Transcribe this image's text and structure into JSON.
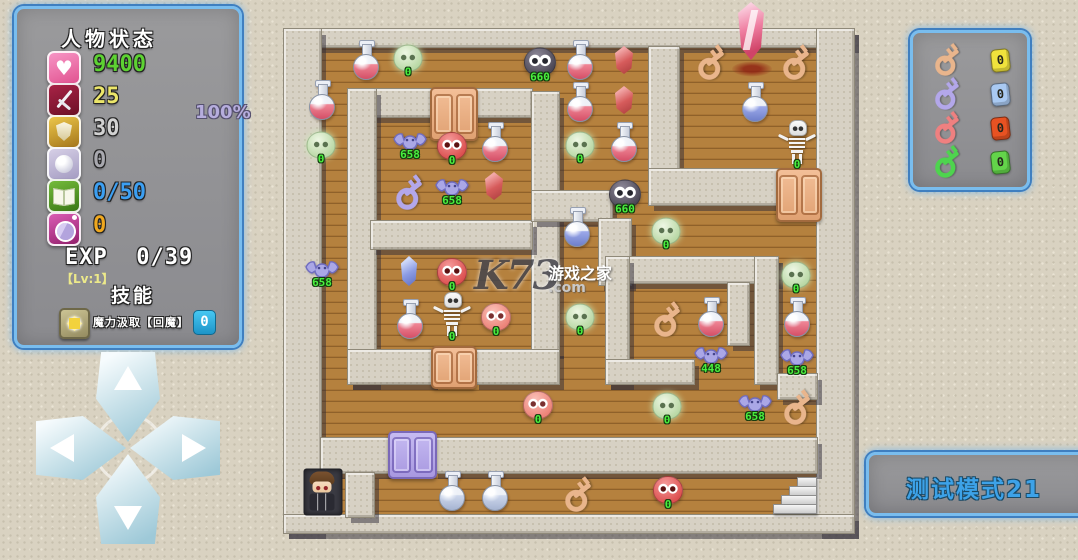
{
  "status_panel": {
    "title": "人物状态",
    "hit_rate": "100%",
    "stats": [
      {
        "icon": "heart",
        "value": "9400",
        "color": "#5dd232"
      },
      {
        "icon": "attack",
        "value": "25",
        "color": "#ece66a"
      },
      {
        "icon": "shield",
        "value": "30",
        "color": "#d2d2d2"
      },
      {
        "icon": "orb",
        "value": "0",
        "color": "#a9a9af"
      },
      {
        "icon": "book",
        "value": "0/50",
        "color": "#3c9ff2"
      },
      {
        "icon": "coin",
        "value": "0",
        "color": "#f0a81e"
      }
    ],
    "exp_label": "EXP",
    "exp_value": "0/39",
    "level": "【Lv:1】",
    "skills_title": "技能",
    "skill": {
      "name": "魔力汲取【回魔】",
      "value": "0"
    }
  },
  "key_panel": {
    "keys": [
      {
        "name": "orange-key",
        "count": "0",
        "key_class": "orange",
        "badge_color": "#f0e23c"
      },
      {
        "name": "blue-key",
        "count": "0",
        "key_class": "purple",
        "badge_color": "#a9c9f2"
      },
      {
        "name": "red-key",
        "count": "0",
        "key_class": "redk",
        "badge_color": "#e85222"
      },
      {
        "name": "green-key",
        "count": "0",
        "key_class": "greenk",
        "badge_color": "#63d44a"
      }
    ]
  },
  "mode_label": "测试模式21",
  "watermark": {
    "logo": "K73",
    "site_name": "游戏之家",
    "domain": ".com"
  },
  "dpad": {
    "directions": [
      "up",
      "left",
      "right",
      "down"
    ]
  },
  "maze": {
    "origin": {
      "x": 283,
      "y": 28
    },
    "walls": [
      [
        283,
        28,
        570,
        18
      ],
      [
        283,
        28,
        37,
        504
      ],
      [
        816,
        28,
        37,
        504
      ],
      [
        283,
        514,
        570,
        18
      ],
      [
        648,
        46,
        30,
        152
      ],
      [
        648,
        168,
        132,
        36
      ],
      [
        347,
        88,
        184,
        28
      ],
      [
        347,
        88,
        28,
        295
      ],
      [
        531,
        91,
        27,
        261
      ],
      [
        370,
        220,
        161,
        28
      ],
      [
        347,
        349,
        85,
        34
      ],
      [
        473,
        349,
        85,
        34
      ],
      [
        531,
        190,
        80,
        30
      ],
      [
        598,
        218,
        32,
        66
      ],
      [
        605,
        256,
        172,
        26
      ],
      [
        605,
        256,
        23,
        127
      ],
      [
        605,
        359,
        88,
        24
      ],
      [
        754,
        256,
        23,
        127
      ],
      [
        727,
        282,
        21,
        62
      ],
      [
        777,
        373,
        39,
        25
      ],
      [
        320,
        437,
        69,
        35
      ],
      [
        432,
        437,
        384,
        35
      ],
      [
        345,
        472,
        28,
        44
      ]
    ],
    "doors": [
      {
        "x": 430,
        "y": 87,
        "w": 44,
        "h": 50,
        "color": "orange"
      },
      {
        "x": 776,
        "y": 168,
        "w": 42,
        "h": 50,
        "color": "orange"
      },
      {
        "x": 431,
        "y": 346,
        "w": 42,
        "h": 39,
        "color": "orange"
      },
      {
        "x": 388,
        "y": 431,
        "w": 45,
        "h": 44,
        "color": "purple"
      }
    ],
    "items": [
      {
        "type": "red-potion",
        "x": 366,
        "y": 60
      },
      {
        "type": "green-slime",
        "x": 408,
        "y": 58,
        "value": "0"
      },
      {
        "type": "dark-monster",
        "x": 540,
        "y": 62,
        "value": "660"
      },
      {
        "type": "red-potion",
        "x": 580,
        "y": 60
      },
      {
        "type": "red-gem",
        "x": 624,
        "y": 60
      },
      {
        "type": "orange-key",
        "x": 710,
        "y": 60
      },
      {
        "type": "pink-crystal",
        "x": 751,
        "y": 31
      },
      {
        "type": "blood-stain",
        "x": 752,
        "y": 69
      },
      {
        "type": "orange-key",
        "x": 795,
        "y": 60
      },
      {
        "type": "red-potion",
        "x": 322,
        "y": 100
      },
      {
        "type": "red-potion",
        "x": 580,
        "y": 102
      },
      {
        "type": "red-gem",
        "x": 624,
        "y": 100
      },
      {
        "type": "blue-potion",
        "x": 755,
        "y": 102
      },
      {
        "type": "green-slime",
        "x": 321,
        "y": 145,
        "value": "0"
      },
      {
        "type": "purple-bat",
        "x": 410,
        "y": 143,
        "value": "658"
      },
      {
        "type": "red-monster",
        "x": 452,
        "y": 146,
        "value": "0"
      },
      {
        "type": "red-potion",
        "x": 495,
        "y": 142
      },
      {
        "type": "green-slime",
        "x": 580,
        "y": 145,
        "value": "0"
      },
      {
        "type": "red-potion",
        "x": 624,
        "y": 142
      },
      {
        "type": "skeleton",
        "x": 797,
        "y": 142,
        "value": "0"
      },
      {
        "type": "purple-key",
        "x": 408,
        "y": 190
      },
      {
        "type": "purple-bat",
        "x": 452,
        "y": 189,
        "value": "658"
      },
      {
        "type": "red-gem",
        "x": 494,
        "y": 186
      },
      {
        "type": "dark-monster",
        "x": 625,
        "y": 194,
        "value": "660"
      },
      {
        "type": "blue-potion",
        "x": 577,
        "y": 227
      },
      {
        "type": "green-slime",
        "x": 666,
        "y": 231,
        "value": "0"
      },
      {
        "type": "purple-bat",
        "x": 322,
        "y": 271,
        "value": "658"
      },
      {
        "type": "blue-gem",
        "x": 409,
        "y": 271
      },
      {
        "type": "red-monster",
        "x": 452,
        "y": 272,
        "value": "0"
      },
      {
        "type": "green-slime",
        "x": 796,
        "y": 275,
        "value": "0"
      },
      {
        "type": "red-potion",
        "x": 410,
        "y": 319
      },
      {
        "type": "skeleton",
        "x": 452,
        "y": 314,
        "value": "0"
      },
      {
        "type": "pink-monster",
        "x": 496,
        "y": 317,
        "value": "0"
      },
      {
        "type": "green-slime",
        "x": 580,
        "y": 317,
        "value": "0"
      },
      {
        "type": "orange-key",
        "x": 666,
        "y": 317
      },
      {
        "type": "red-potion",
        "x": 711,
        "y": 317
      },
      {
        "type": "red-potion",
        "x": 797,
        "y": 317
      },
      {
        "type": "purple-bat",
        "x": 711,
        "y": 357,
        "value": "448"
      },
      {
        "type": "purple-bat",
        "x": 797,
        "y": 359,
        "value": "658"
      },
      {
        "type": "pink-monster",
        "x": 538,
        "y": 405,
        "value": "0"
      },
      {
        "type": "green-slime",
        "x": 667,
        "y": 406,
        "value": "0"
      },
      {
        "type": "purple-bat",
        "x": 755,
        "y": 405,
        "value": "658"
      },
      {
        "type": "orange-key",
        "x": 796,
        "y": 405
      },
      {
        "type": "player",
        "x": 323,
        "y": 492
      },
      {
        "type": "silver-potion",
        "x": 452,
        "y": 491
      },
      {
        "type": "silver-potion",
        "x": 495,
        "y": 491
      },
      {
        "type": "orange-key",
        "x": 577,
        "y": 492
      },
      {
        "type": "red-monster",
        "x": 668,
        "y": 490,
        "value": "0"
      },
      {
        "type": "stairs",
        "x": 796,
        "y": 496
      }
    ]
  }
}
